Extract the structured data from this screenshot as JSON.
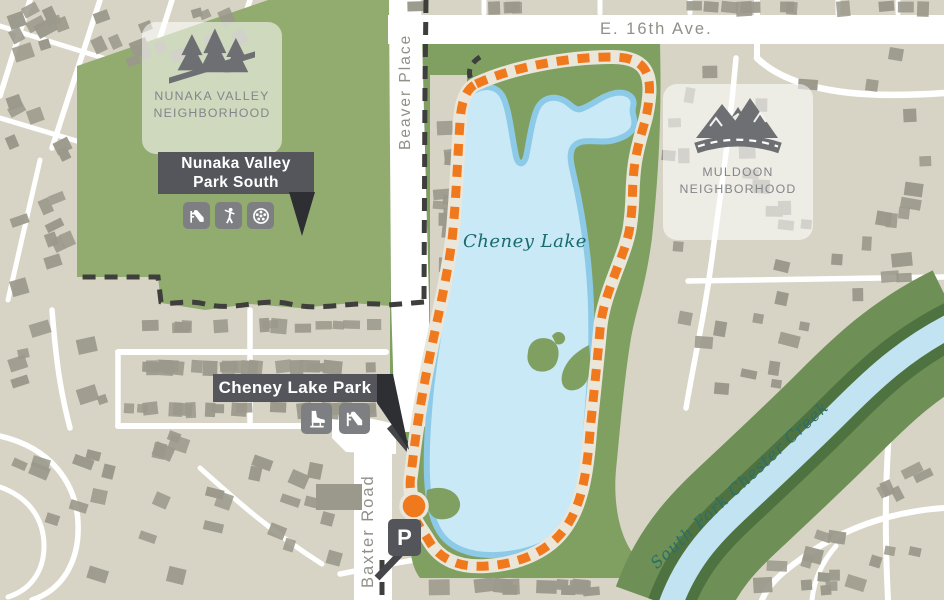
{
  "title": "Cheney Lake trail map",
  "streets": {
    "e16th": "E. 16th Ave.",
    "beaver": "Beaver Place",
    "baxter": "Baxter Road"
  },
  "water": {
    "lake": "Cheney Lake",
    "creek": "South Fork Chester Creek"
  },
  "neighborhoods": {
    "nunaka": {
      "line1": "NUNAKA VALLEY",
      "line2": "NEIGHBORHOOD",
      "icon": "pine-trees-trail-icon"
    },
    "muldoon": {
      "line1": "MULDOON",
      "line2": "NEIGHBORHOOD",
      "icon": "mountains-road-icon"
    }
  },
  "parks": {
    "nunaka_park": {
      "name_line1": "Nunaka Valley",
      "name_line2": "Park South",
      "amenities": [
        "playground-slide",
        "golf",
        "sports-ball"
      ]
    },
    "cheney_park": {
      "name": "Cheney Lake Park",
      "amenities": [
        "ice-skating",
        "playground-slide"
      ]
    }
  },
  "markers": {
    "parking_label": "P",
    "trailhead": "trailhead-dot"
  },
  "colors": {
    "land": "#D7D4C6",
    "house": "#9B998B",
    "road": "#FFFFFF",
    "park_green": "#92AC70",
    "lake_park_green": "#80A062",
    "creek_band_green": "#6E8F55",
    "creek_dark_green": "#4F7340",
    "lake_fill": "#C9E9F6",
    "lake_edge": "#8CCAE8",
    "creek_water": "#C2E4F2",
    "trail_orange": "#F0791E",
    "trail_base": "#EAE6DA",
    "boundary_dark": "#3E3F3C",
    "banner_bg": "#55565C",
    "banner_point": "#2E2F33",
    "badge_bg": "rgba(255,255,255,0.55)",
    "badge_ink": "#6E6F73",
    "badge_text": "#84858A",
    "street_text": "#8F9089",
    "lake_text": "#1A6B6F",
    "creek_text": "#2A6E68",
    "icon_tile": "#7E7F83",
    "parking_bg": "#54555A"
  }
}
